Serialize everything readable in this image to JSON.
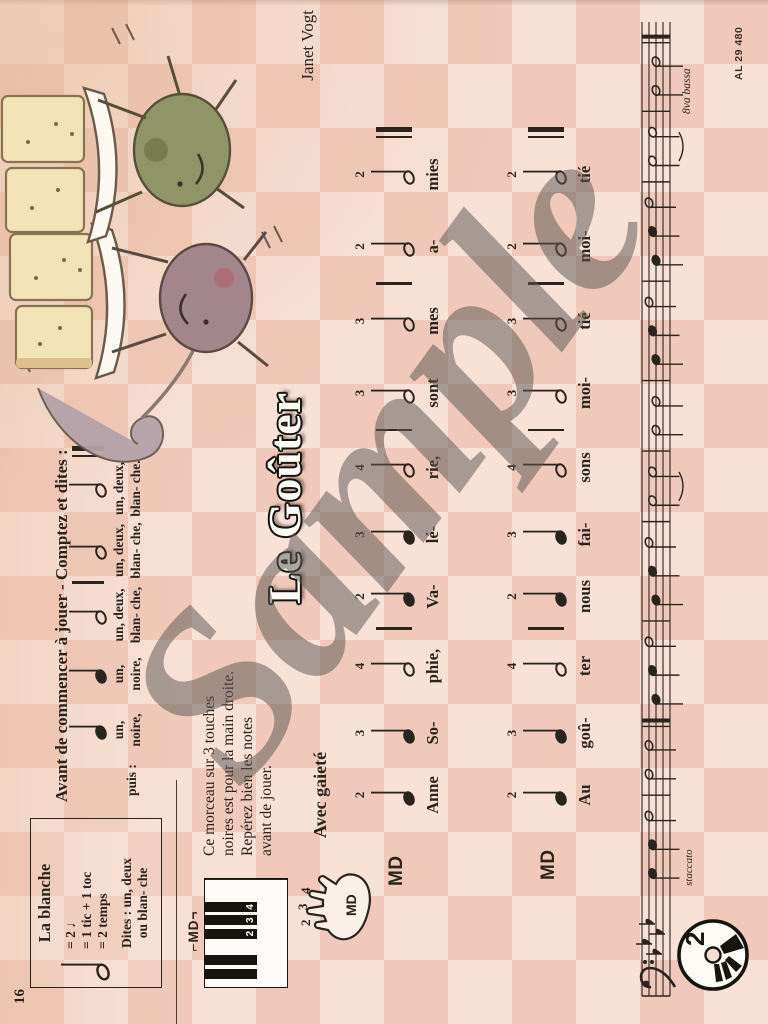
{
  "page": {
    "number": "16",
    "plate": "AL 29 480",
    "title": "Le Goûter",
    "composer": "Janet Vogt",
    "tempo": "Avec gaieté",
    "watermark": "Sample"
  },
  "colors": {
    "ink": "#29241e",
    "checker_light": "#f8e1d7",
    "checker_dark": "#f1c9ba",
    "toast": "#f2e4b6",
    "plate": "#fcf9f2",
    "char_green": "#8f9566",
    "char_plum": "#a3858c"
  },
  "blanche_box": {
    "title": "La blanche",
    "eq_lines": [
      "= 2 ♩",
      "= 1 tic + 1 toc",
      "= 2 temps"
    ],
    "dites": "Dites : un, deux",
    "ou": "ou blan- che"
  },
  "counting": {
    "heading": "Avant de commencer à jouer - Comptez et dites :",
    "puis": "puis :",
    "tokens": [
      {
        "t": "q",
        "count": "un,",
        "name": "noire,"
      },
      {
        "t": "q",
        "count": "un,",
        "name": "noire,"
      },
      {
        "t": "h",
        "count": "un, deux,",
        "name": "blan- che,"
      },
      {
        "t": "bar"
      },
      {
        "t": "h",
        "count": "un, deux,",
        "name": "blan- che,"
      },
      {
        "t": "h",
        "count": "un, deux,",
        "name": "blan- che."
      },
      {
        "t": "dbar"
      }
    ]
  },
  "instructions": {
    "lines": [
      "Ce morceau sur 3 touches",
      "noires est pour la main droite.",
      "Repérez bien les notes",
      "avant de jouer."
    ]
  },
  "keyboard": {
    "hand_label": "⌐MD¬",
    "black_key_numbers": [
      "2",
      "3",
      "4"
    ]
  },
  "hand": {
    "fingers": [
      "2",
      "3",
      "4"
    ],
    "palm_label": "MD"
  },
  "systems": [
    {
      "hand": "MD",
      "cells": [
        {
          "t": "q",
          "f": "2",
          "lyric": "Anne"
        },
        {
          "t": "q",
          "f": "3",
          "lyric": "So-"
        },
        {
          "t": "h",
          "f": "4",
          "lyric": "phie,"
        },
        {
          "t": "bar"
        },
        {
          "t": "q",
          "f": "2",
          "lyric": "Va-"
        },
        {
          "t": "q",
          "f": "3",
          "lyric": "lé-"
        },
        {
          "t": "h",
          "f": "4",
          "lyric": "rie,"
        },
        {
          "t": "bar"
        },
        {
          "t": "h",
          "f": "3",
          "lyric": "sont"
        },
        {
          "t": "h",
          "f": "3",
          "lyric": "mes"
        },
        {
          "t": "bar"
        },
        {
          "t": "h",
          "f": "2",
          "lyric": "a-"
        },
        {
          "t": "h",
          "f": "2",
          "lyric": "mies"
        },
        {
          "t": "dbar"
        }
      ]
    },
    {
      "hand": "MD",
      "cells": [
        {
          "t": "q",
          "f": "2",
          "lyric": "Au"
        },
        {
          "t": "q",
          "f": "3",
          "lyric": "goû-"
        },
        {
          "t": "h",
          "f": "4",
          "lyric": "ter"
        },
        {
          "t": "bar"
        },
        {
          "t": "q",
          "f": "2",
          "lyric": "nous"
        },
        {
          "t": "q",
          "f": "3",
          "lyric": "fai-"
        },
        {
          "t": "h",
          "f": "4",
          "lyric": "sons"
        },
        {
          "t": "bar"
        },
        {
          "t": "h",
          "f": "3",
          "lyric": "moi-"
        },
        {
          "t": "h",
          "f": "3",
          "lyric": "tié"
        },
        {
          "t": "bar"
        },
        {
          "t": "h",
          "f": "2",
          "lyric": "moi-"
        },
        {
          "t": "h",
          "f": "2",
          "lyric": "tié"
        },
        {
          "t": "dbar"
        }
      ]
    }
  ],
  "staff": {
    "clef": "bass",
    "flats": 4,
    "staccato_label": "staccato",
    "octave_label": "8va bassa",
    "cd_number": "2",
    "slurs": [
      [
        15,
        16
      ],
      [
        29,
        30
      ]
    ],
    "tokens": [
      {
        "t": "q",
        "p": 3
      },
      {
        "t": "q",
        "p": 3
      },
      {
        "t": "h",
        "p": 2
      },
      {
        "t": "bar"
      },
      {
        "t": "h",
        "p": 2
      },
      {
        "t": "h",
        "p": 2
      },
      {
        "t": "end"
      },
      {
        "t": "q",
        "p": 4
      },
      {
        "t": "q",
        "p": 3
      },
      {
        "t": "h",
        "p": 2
      },
      {
        "t": "bar"
      },
      {
        "t": "q",
        "p": 4
      },
      {
        "t": "q",
        "p": 3
      },
      {
        "t": "h",
        "p": 2
      },
      {
        "t": "bar"
      },
      {
        "t": "h",
        "p": 3
      },
      {
        "t": "h",
        "p": 3
      },
      {
        "t": "bar"
      },
      {
        "t": "h",
        "p": 4
      },
      {
        "t": "h",
        "p": 4
      },
      {
        "t": "bar"
      },
      {
        "t": "q",
        "p": 4
      },
      {
        "t": "q",
        "p": 3
      },
      {
        "t": "h",
        "p": 2
      },
      {
        "t": "bar"
      },
      {
        "t": "q",
        "p": 4
      },
      {
        "t": "q",
        "p": 3
      },
      {
        "t": "h",
        "p": 2
      },
      {
        "t": "bar"
      },
      {
        "t": "h",
        "p": 3
      },
      {
        "t": "h",
        "p": 3
      },
      {
        "t": "bar"
      },
      {
        "t": "h",
        "p": 4
      },
      {
        "t": "h",
        "p": 4
      },
      {
        "t": "end"
      }
    ]
  }
}
